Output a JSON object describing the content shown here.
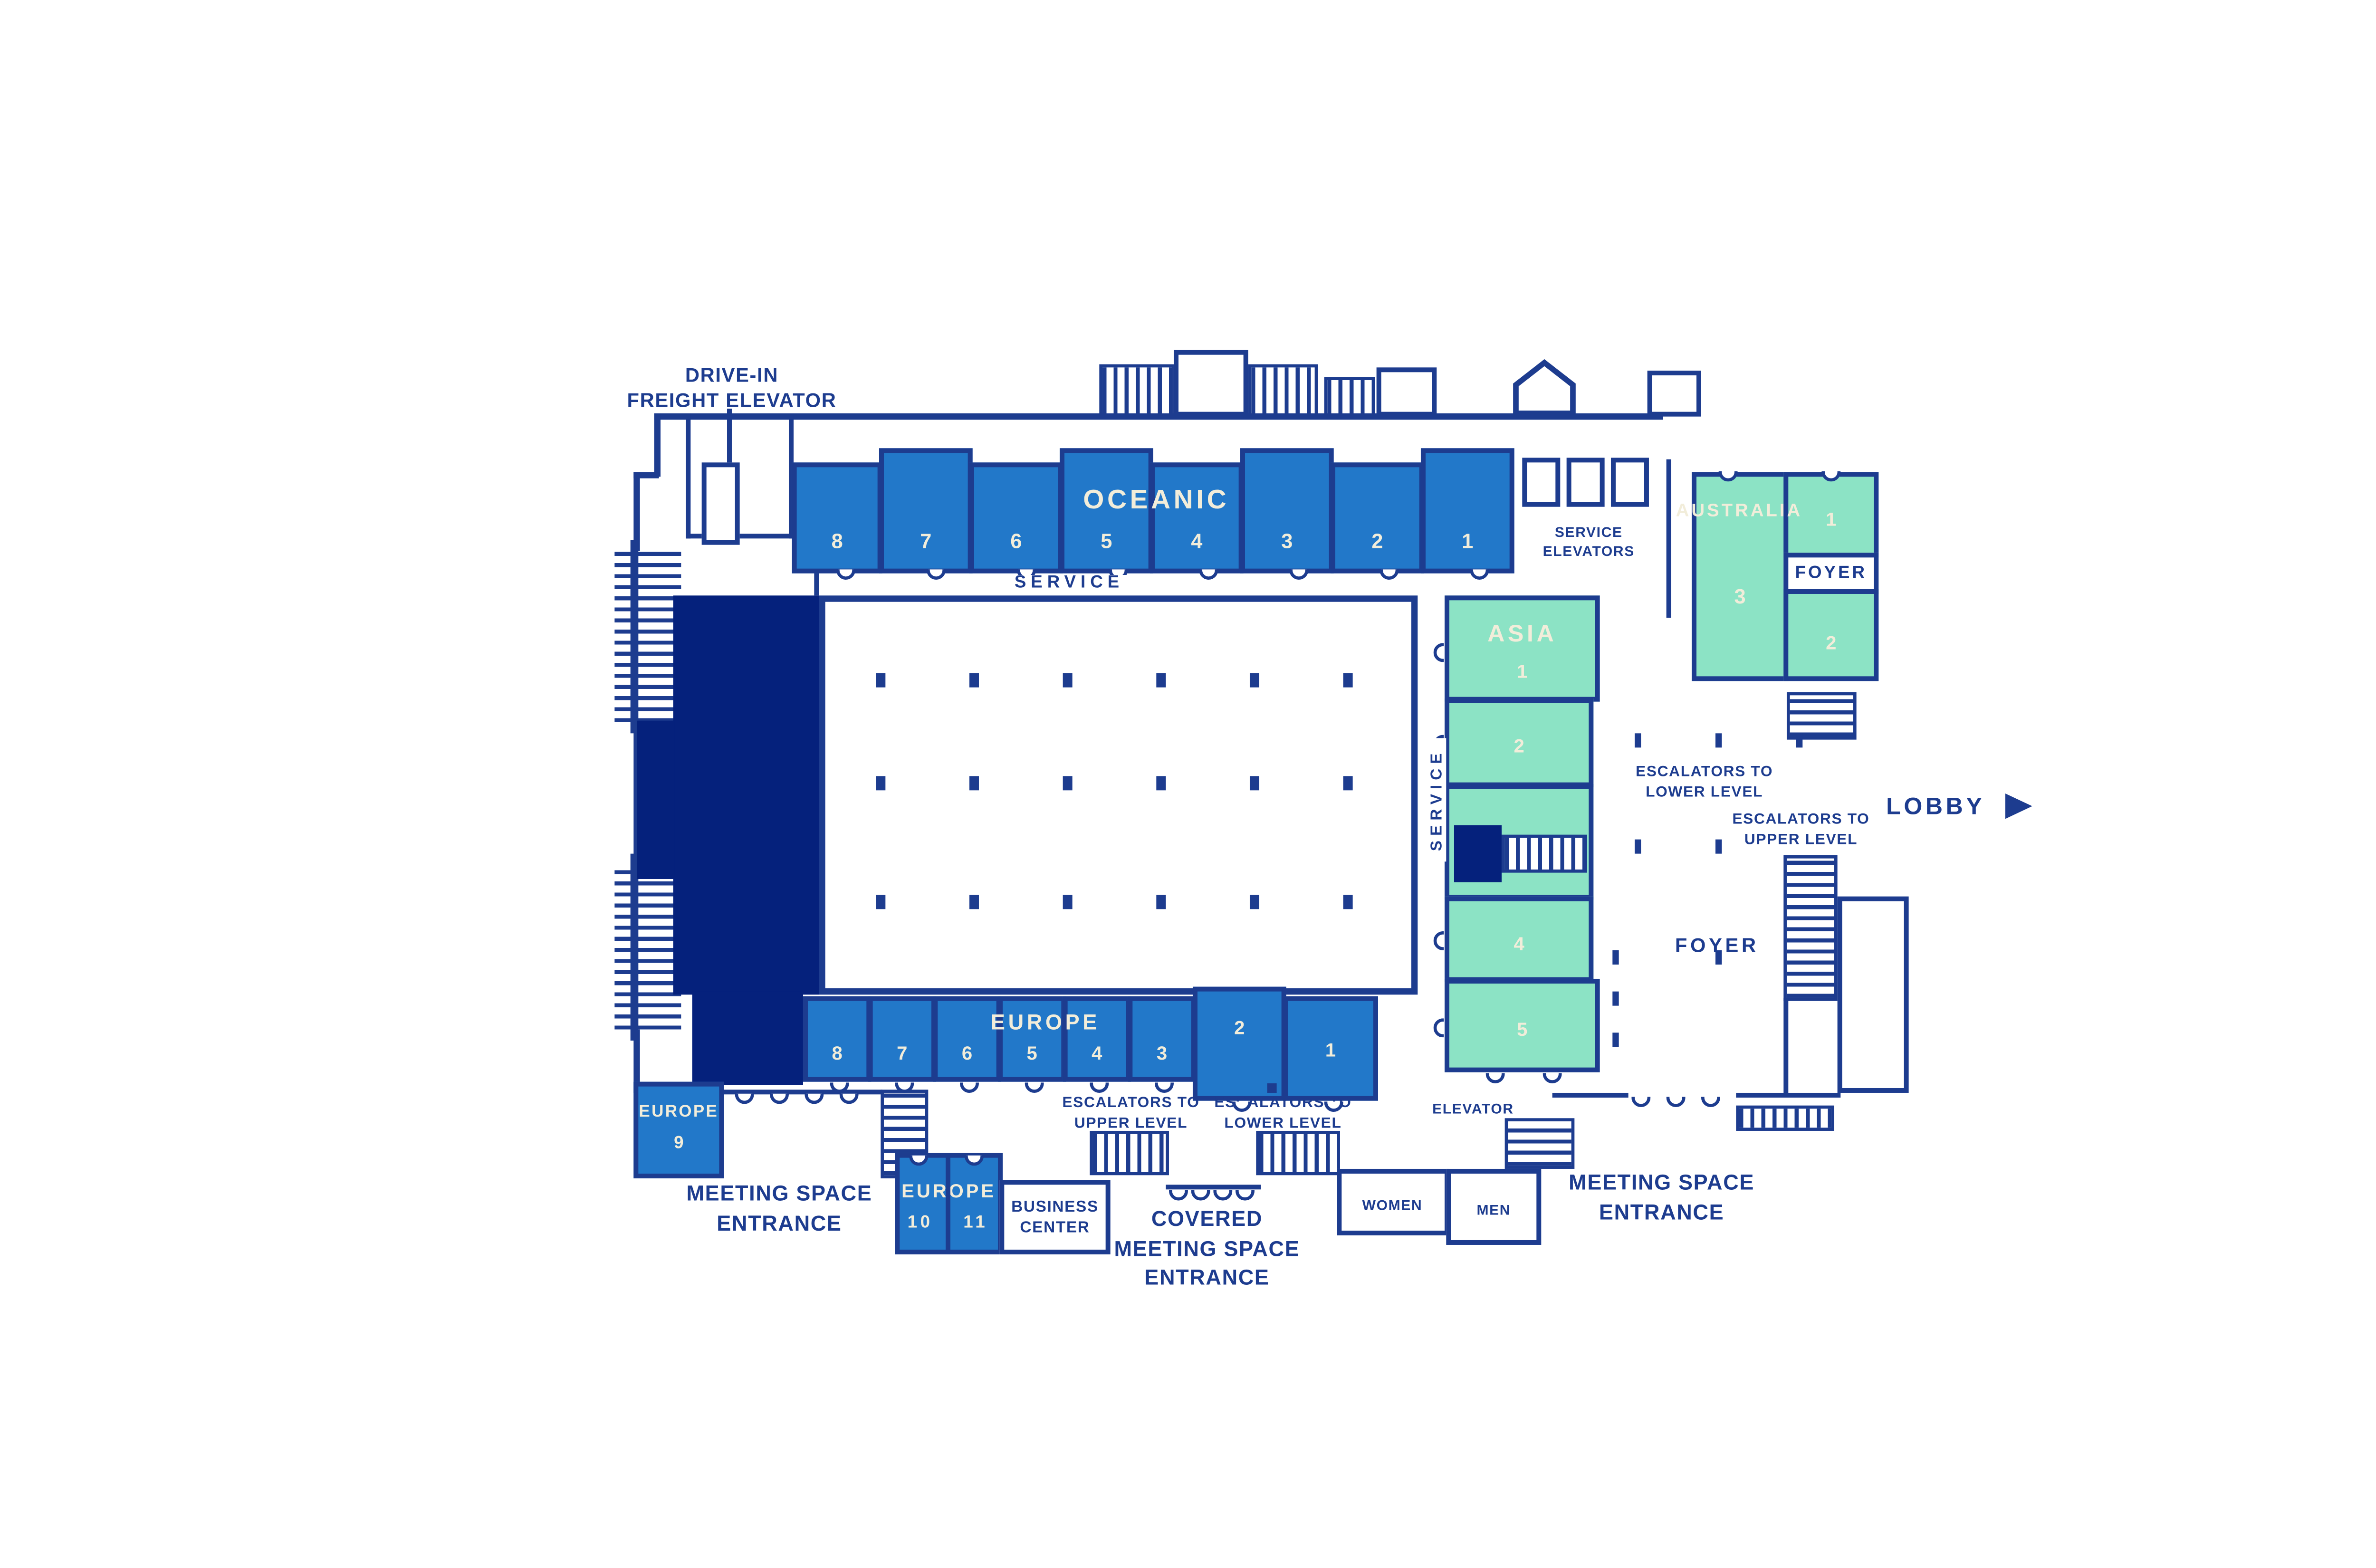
{
  "colors": {
    "wall_navy": "#1d3c8f",
    "room_blue": "#2278c9",
    "room_green": "#8ce3c5",
    "stage_dark_navy": "#05217c",
    "room_label_cream": "#f2edda",
    "background": "#ffffff"
  },
  "labels": {
    "drive_in_freight_elevator": {
      "line1": "DRIVE-IN",
      "line2": "FREIGHT ELEVATOR"
    },
    "service_top": "SERVICE",
    "service_vertical": "SERVICE",
    "service_elevators": {
      "line1": "SERVICE",
      "line2": "ELEVATORS"
    },
    "foyer_australia": "FOYER",
    "foyer_main": "FOYER",
    "lobby": "LOBBY",
    "escalators_lower_foyer": {
      "line1": "ESCALATORS TO",
      "line2": "LOWER LEVEL"
    },
    "escalators_upper_foyer": {
      "line1": "ESCALATORS TO",
      "line2": "UPPER LEVEL"
    },
    "escalators_upper_bottom": {
      "line1": "ESCALATORS TO",
      "line2": "UPPER LEVEL"
    },
    "escalators_lower_bottom": {
      "line1": "ESCALATORS TO",
      "line2": "LOWER LEVEL"
    },
    "meeting_entrance_left": {
      "line1": "MEETING SPACE",
      "line2": "ENTRANCE"
    },
    "meeting_entrance_right": {
      "line1": "MEETING SPACE",
      "line2": "ENTRANCE"
    },
    "covered_entrance": {
      "line1": "COVERED",
      "line2": "MEETING SPACE",
      "line3": "ENTRANCE"
    },
    "business_center": {
      "line1": "BUSINESS",
      "line2": "CENTER"
    },
    "women": "WOMEN",
    "men": "MEN",
    "elevator": "ELEVATOR"
  },
  "rooms": {
    "oceanic": {
      "title": "OCEANIC",
      "numbers": [
        "8",
        "7",
        "6",
        "5",
        "4",
        "3",
        "2",
        "1"
      ]
    },
    "europe": {
      "title": "EUROPE",
      "numbers": [
        "8",
        "7",
        "6",
        "5",
        "4",
        "3"
      ],
      "number_2": "2",
      "number_1": "1"
    },
    "europe9": {
      "title": "EUROPE",
      "number": "9"
    },
    "europe1011": {
      "title": "EUROPE",
      "number_10": "10",
      "number_11": "11"
    },
    "asia": {
      "title": "ASIA",
      "numbers": [
        "1",
        "2",
        "3",
        "4",
        "5"
      ]
    },
    "australia": {
      "title": "AUSTRALIA",
      "number_1": "1",
      "number_2": "2",
      "number_3": "3"
    }
  }
}
